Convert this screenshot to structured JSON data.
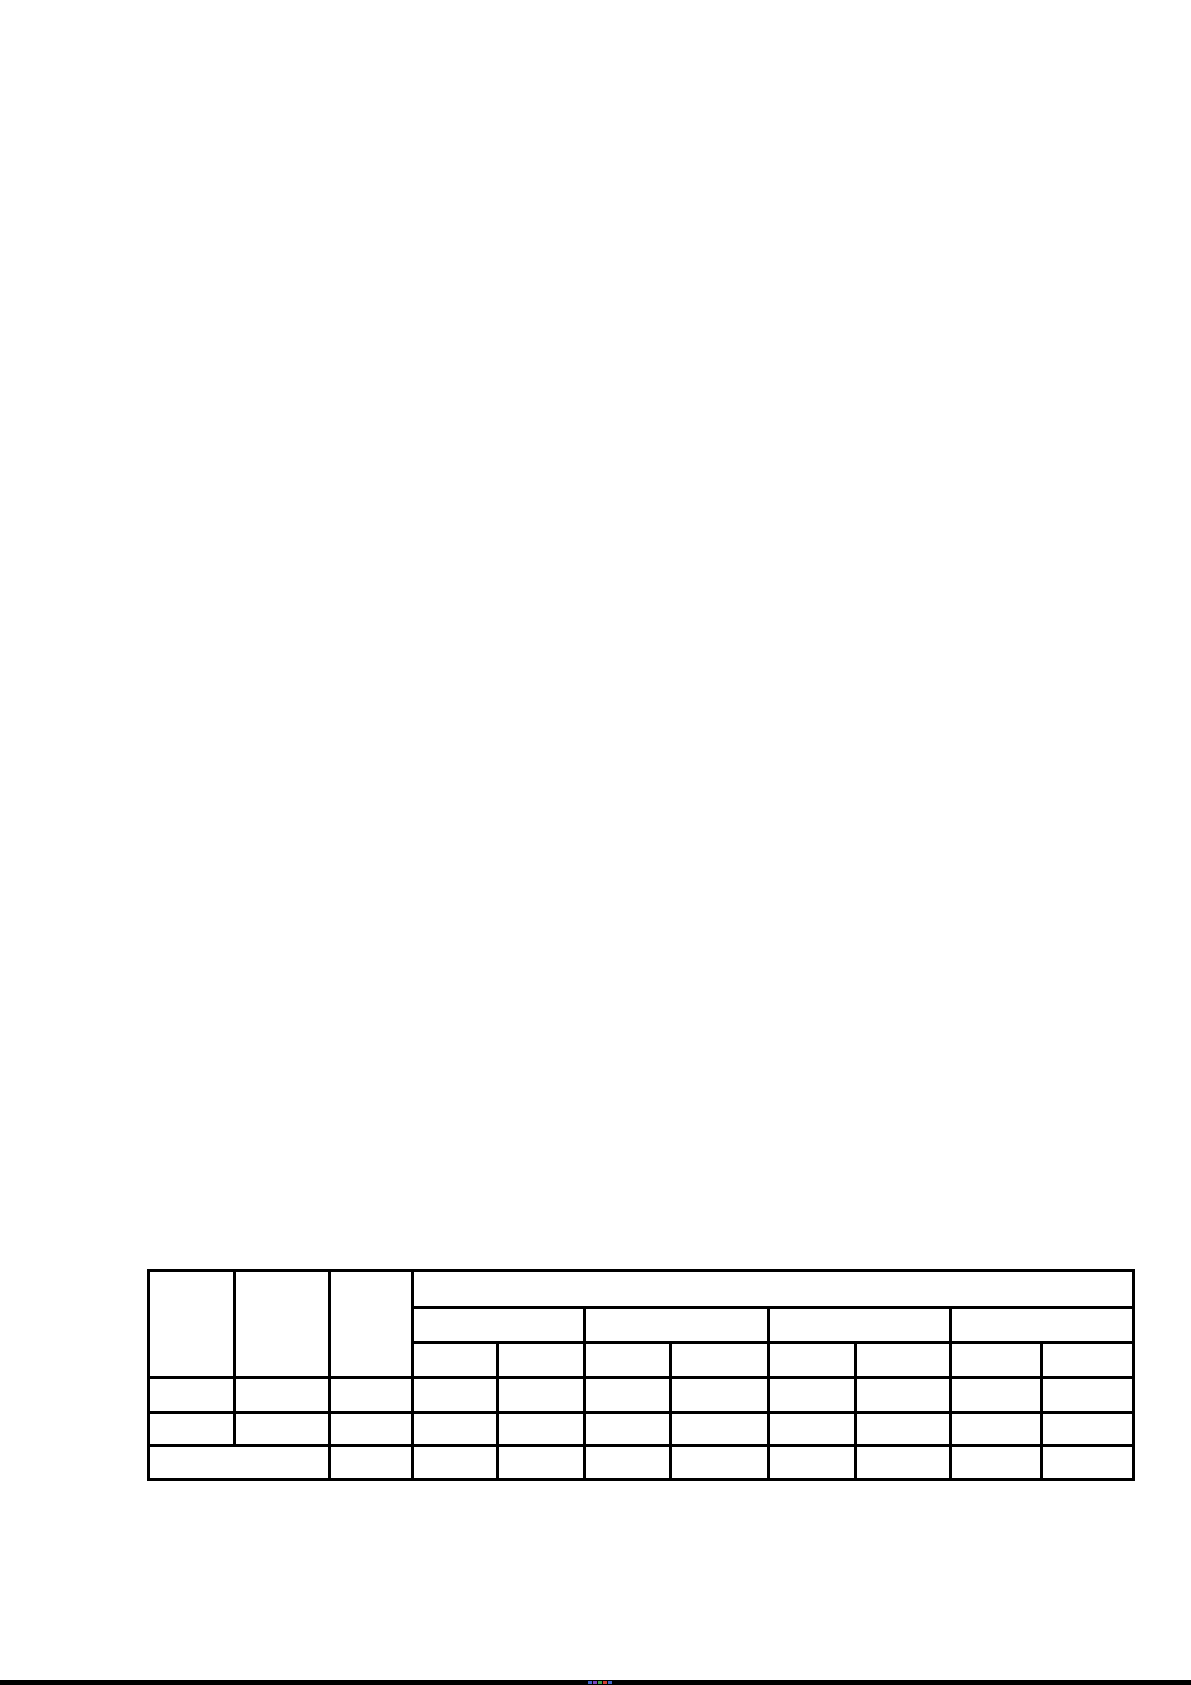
{
  "page": {
    "background": "#ffffff",
    "width": 1191,
    "height": 1685
  },
  "document_table": {
    "border_color": "#000000",
    "border_width": 3,
    "left": 147,
    "top": 1269,
    "column_widths": [
      86,
      95,
      83,
      85,
      87,
      86,
      98,
      87,
      95,
      91,
      92
    ],
    "rows": [
      {
        "height": 37,
        "cells": [
          {
            "rowspan": 3,
            "colspan": 1,
            "text": ""
          },
          {
            "rowspan": 3,
            "colspan": 1,
            "text": ""
          },
          {
            "rowspan": 3,
            "colspan": 1,
            "text": ""
          },
          {
            "rowspan": 1,
            "colspan": 8,
            "text": ""
          }
        ]
      },
      {
        "height": 35,
        "cells": [
          {
            "rowspan": 1,
            "colspan": 2,
            "text": ""
          },
          {
            "rowspan": 1,
            "colspan": 2,
            "text": ""
          },
          {
            "rowspan": 1,
            "colspan": 2,
            "text": ""
          },
          {
            "rowspan": 1,
            "colspan": 2,
            "text": ""
          }
        ]
      },
      {
        "height": 35,
        "cells": [
          {
            "rowspan": 1,
            "colspan": 1,
            "text": ""
          },
          {
            "rowspan": 1,
            "colspan": 1,
            "text": ""
          },
          {
            "rowspan": 1,
            "colspan": 1,
            "text": ""
          },
          {
            "rowspan": 1,
            "colspan": 1,
            "text": ""
          },
          {
            "rowspan": 1,
            "colspan": 1,
            "text": ""
          },
          {
            "rowspan": 1,
            "colspan": 1,
            "text": ""
          },
          {
            "rowspan": 1,
            "colspan": 1,
            "text": ""
          },
          {
            "rowspan": 1,
            "colspan": 1,
            "text": ""
          }
        ]
      },
      {
        "height": 35,
        "cells": [
          {
            "rowspan": 1,
            "colspan": 1,
            "text": ""
          },
          {
            "rowspan": 1,
            "colspan": 1,
            "text": ""
          },
          {
            "rowspan": 1,
            "colspan": 1,
            "text": ""
          },
          {
            "rowspan": 1,
            "colspan": 1,
            "text": ""
          },
          {
            "rowspan": 1,
            "colspan": 1,
            "text": ""
          },
          {
            "rowspan": 1,
            "colspan": 1,
            "text": ""
          },
          {
            "rowspan": 1,
            "colspan": 1,
            "text": ""
          },
          {
            "rowspan": 1,
            "colspan": 1,
            "text": ""
          },
          {
            "rowspan": 1,
            "colspan": 1,
            "text": ""
          },
          {
            "rowspan": 1,
            "colspan": 1,
            "text": ""
          },
          {
            "rowspan": 1,
            "colspan": 1,
            "text": ""
          }
        ]
      },
      {
        "height": 33,
        "cells": [
          {
            "rowspan": 1,
            "colspan": 1,
            "text": ""
          },
          {
            "rowspan": 1,
            "colspan": 1,
            "text": ""
          },
          {
            "rowspan": 1,
            "colspan": 1,
            "text": ""
          },
          {
            "rowspan": 1,
            "colspan": 1,
            "text": ""
          },
          {
            "rowspan": 1,
            "colspan": 1,
            "text": ""
          },
          {
            "rowspan": 1,
            "colspan": 1,
            "text": ""
          },
          {
            "rowspan": 1,
            "colspan": 1,
            "text": ""
          },
          {
            "rowspan": 1,
            "colspan": 1,
            "text": ""
          },
          {
            "rowspan": 1,
            "colspan": 1,
            "text": ""
          },
          {
            "rowspan": 1,
            "colspan": 1,
            "text": ""
          },
          {
            "rowspan": 1,
            "colspan": 1,
            "text": ""
          }
        ]
      },
      {
        "height": 34,
        "cells": [
          {
            "rowspan": 1,
            "colspan": 2,
            "text": ""
          },
          {
            "rowspan": 1,
            "colspan": 1,
            "text": ""
          },
          {
            "rowspan": 1,
            "colspan": 1,
            "text": ""
          },
          {
            "rowspan": 1,
            "colspan": 1,
            "text": ""
          },
          {
            "rowspan": 1,
            "colspan": 1,
            "text": ""
          },
          {
            "rowspan": 1,
            "colspan": 1,
            "text": ""
          },
          {
            "rowspan": 1,
            "colspan": 1,
            "text": ""
          },
          {
            "rowspan": 1,
            "colspan": 1,
            "text": ""
          },
          {
            "rowspan": 1,
            "colspan": 1,
            "text": ""
          },
          {
            "rowspan": 1,
            "colspan": 1,
            "text": ""
          }
        ]
      }
    ]
  },
  "screen_bottom_bar": {
    "color": "#000000",
    "height": 5,
    "icon_pixels": [
      {
        "x": 588,
        "color": "#4063c9"
      },
      {
        "x": 593,
        "color": "#7b44bf"
      },
      {
        "x": 598,
        "color": "#3f9e4d"
      },
      {
        "x": 603,
        "color": "#d23f31"
      },
      {
        "x": 608,
        "color": "#4063c9"
      }
    ]
  }
}
